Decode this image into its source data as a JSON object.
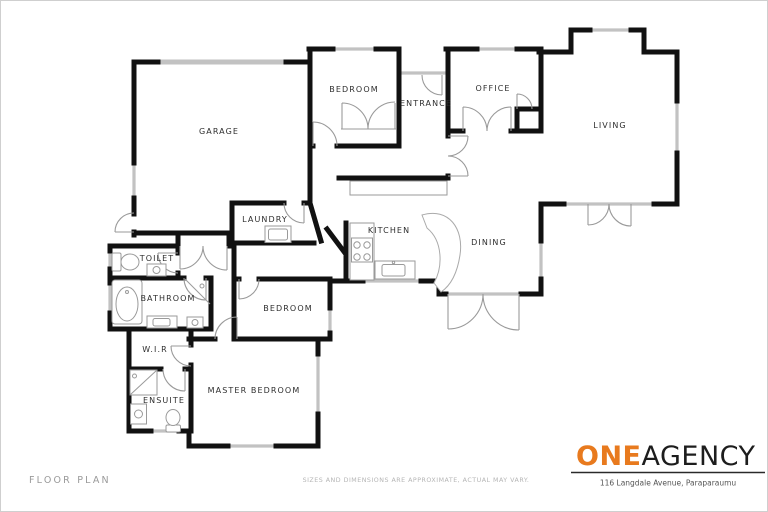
{
  "rooms": {
    "garage": {
      "label": "GARAGE"
    },
    "bedroom_top": {
      "label": "BEDROOM"
    },
    "entrance": {
      "label": "ENTRANCE"
    },
    "office": {
      "label": "OFFICE"
    },
    "living": {
      "label": "LIVING"
    },
    "laundry": {
      "label": "LAUNDRY"
    },
    "kitchen": {
      "label": "KITCHEN"
    },
    "dining": {
      "label": "DINING"
    },
    "toilet": {
      "label": "TOILET"
    },
    "bathroom": {
      "label": "BATHROOM"
    },
    "bedroom_mid": {
      "label": "BEDROOM"
    },
    "wir": {
      "label": "W.I.R"
    },
    "ensuite": {
      "label": "ENSUITE"
    },
    "master": {
      "label": "MASTER BEDROOM"
    }
  },
  "footer": {
    "floor_plan_label": "FLOOR PLAN",
    "disclaimer": "SIZES AND DIMENSIONS ARE APPROXIMATE, ACTUAL MAY VARY.",
    "address": "116 Langdale Avenue, Paraparaumu"
  },
  "logo": {
    "one": "ONE",
    "agency": "AGENCY"
  },
  "colors": {
    "wall": "#111111",
    "window": "#bcbcbc",
    "door_arc": "#9a9a9a",
    "fixture": "#9a9a9a",
    "accent_orange": "#e87a1e",
    "label_text": "#2e2e2e",
    "muted_text": "#b5b5b5"
  }
}
